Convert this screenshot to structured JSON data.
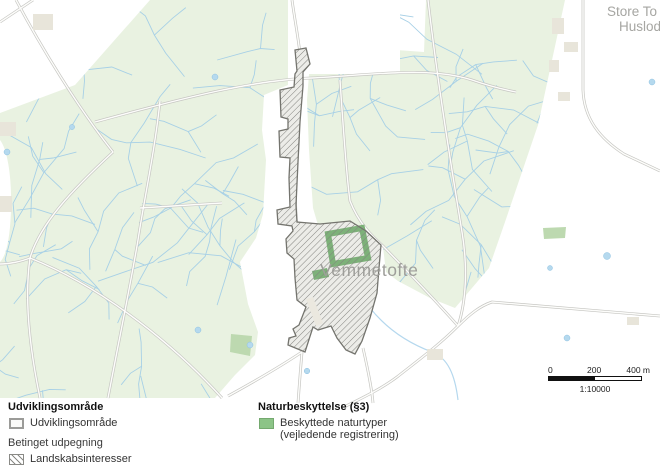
{
  "map": {
    "labels": {
      "place_main": "Vemmetofte",
      "place_ne_line1": "Store To",
      "place_ne_line2": "Huslodd"
    },
    "colors": {
      "forest": "#e9f2e1",
      "field": "#ffffff",
      "forest_path_blue": "#a7d0e6",
      "road_casing": "#c6c6c2",
      "pond_blue": "#b5d9ee",
      "hatch_line": "#82827e",
      "hatch_outline": "#74746e",
      "nature_green": "#61a25c",
      "nature_patch_green": "#bdd9b0",
      "building_beige": "#e8e5da",
      "place_label_gray": "#9e9e9a"
    }
  },
  "legend": {
    "development": {
      "title": "Udviklingsområde",
      "items": [
        {
          "label": "Udviklingsområde",
          "swatch": "outlined-square"
        }
      ]
    },
    "conditional": {
      "title": "Betinget udpegning",
      "items": [
        {
          "label": "Landskabsinteresser",
          "swatch": "diagonal-hatch"
        }
      ]
    },
    "nature": {
      "title": "Naturbeskyttelse (§3)",
      "items": [
        {
          "label_line1": "Beskyttede naturtyper",
          "label_line2": "(vejledende registrering)",
          "swatch": "green-fill"
        }
      ]
    }
  },
  "scalebar": {
    "tick0": "0",
    "tick1": "200",
    "tick2": "400 m",
    "ratio": "1:10000"
  }
}
